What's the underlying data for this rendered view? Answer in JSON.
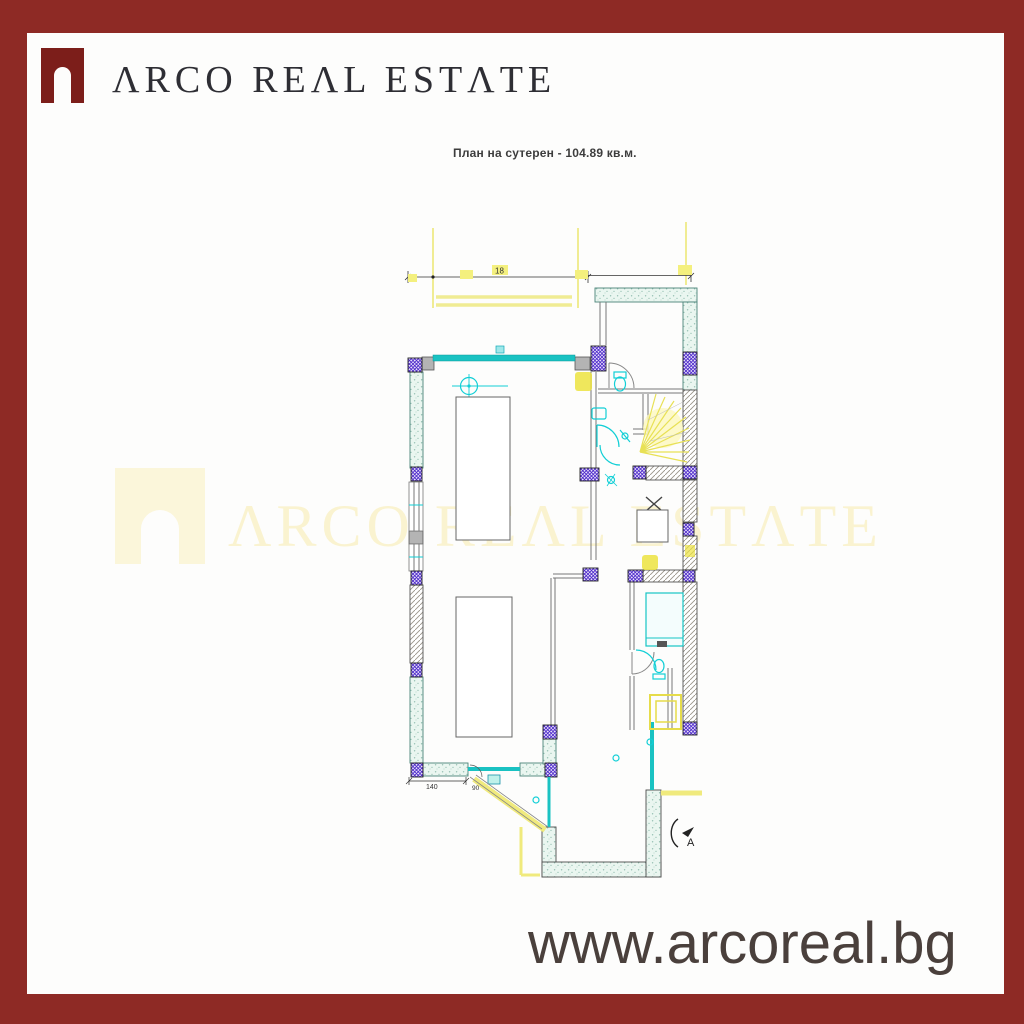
{
  "frame": {
    "border_color": "#8e2a25"
  },
  "header": {
    "logo_icon": "arch-logo-icon",
    "brand_name": "ARCO REAL ESTATE",
    "brand_display": "ΛRCO REΛL ESTΛTE"
  },
  "drawing": {
    "title": "План на сутерен - 104.89 кв.м.",
    "area_sqm": "104.89",
    "labels": {
      "top_dim": "18",
      "left_dim": "140",
      "door_dim": "90",
      "section_marker": "A"
    },
    "colors": {
      "wall_teal": "#1ac2c2",
      "fixture_cyan": "#12cfd6",
      "column_purple": "#4b27c9",
      "construction_yellow": "#f0ec93",
      "highlight_yellow": "#ece33f"
    }
  },
  "watermark": {
    "text": "ARCO REAL ESTATE",
    "display": "ΛRCO REΛL ESTΛTE",
    "icon": "arch-logo-watermark-icon"
  },
  "footer": {
    "website": "www.arcoreal.bg"
  }
}
